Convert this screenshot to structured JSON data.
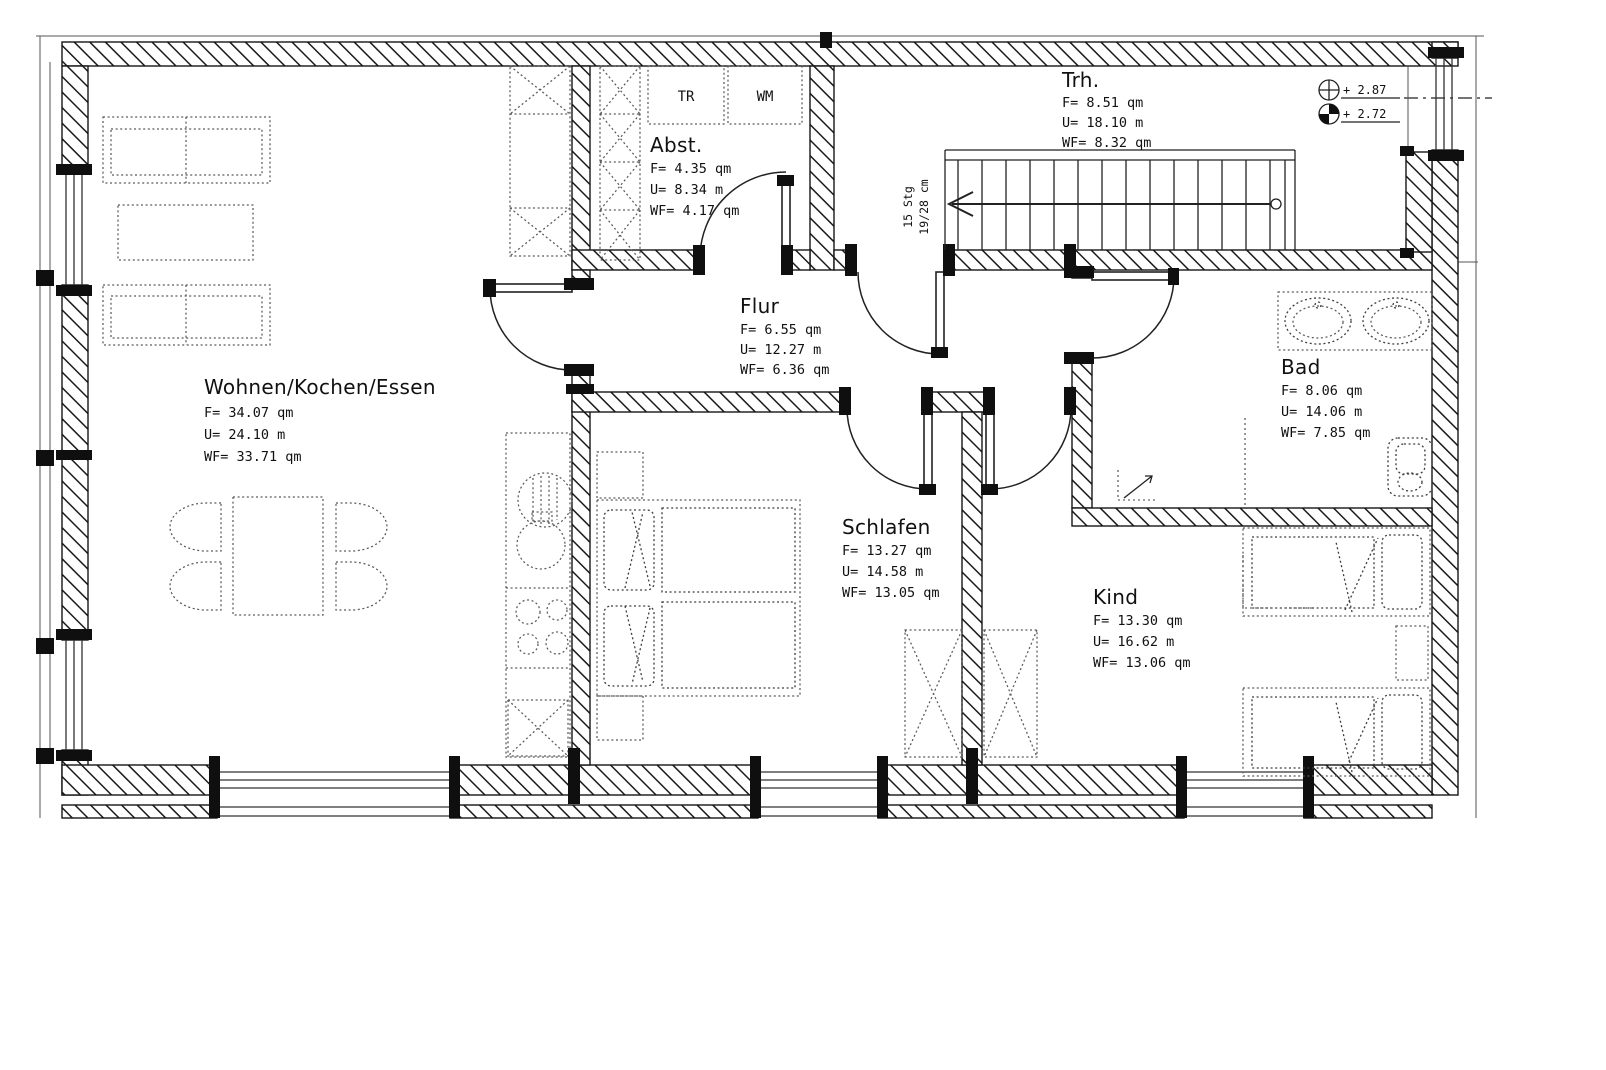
{
  "rooms": [
    {
      "name": "Wohnen/Kochen/Essen",
      "area": "F= 34.07 qm",
      "perimeter": "U= 24.10 m",
      "living": "WF= 33.71 qm"
    },
    {
      "name": "Abst.",
      "area": "F= 4.35 qm",
      "perimeter": "U= 8.34 m",
      "living": "WF= 4.17 qm"
    },
    {
      "name": "Trh.",
      "area": "F= 8.51 qm",
      "perimeter": "U= 18.10 m",
      "living": "WF= 8.32 qm"
    },
    {
      "name": "Flur",
      "area": "F= 6.55 qm",
      "perimeter": "U= 12.27 m",
      "living": "WF= 6.36 qm"
    },
    {
      "name": "Bad",
      "area": "F= 8.06 qm",
      "perimeter": "U= 14.06 m",
      "living": "WF= 7.85 qm"
    },
    {
      "name": "Schlafen",
      "area": "F= 13.27 qm",
      "perimeter": "U= 14.58 m",
      "living": "WF= 13.05 qm"
    },
    {
      "name": "Kind",
      "area": "F= 13.30 qm",
      "perimeter": "U= 16.62 m",
      "living": "WF= 13.06 qm"
    }
  ],
  "appliances": {
    "dryer": "TR",
    "washer": "WM"
  },
  "stair": {
    "steps": "15 Stg",
    "rise_run": "19/28 cm"
  },
  "levels": {
    "upper": "+ 2.87",
    "lower": "+ 2.72"
  },
  "colors": {
    "ink": "#161616",
    "furniture": "#5a5a5a",
    "paper": "#ffffff"
  }
}
